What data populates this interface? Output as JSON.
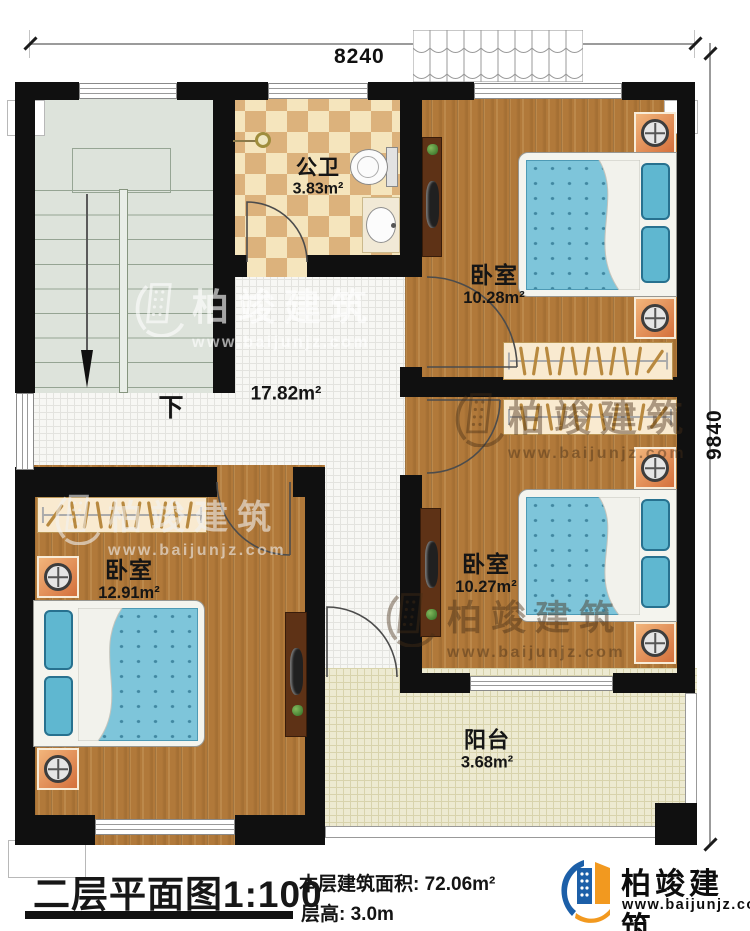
{
  "dimensions": {
    "width_mm": "8240",
    "height_mm": "9840"
  },
  "rooms": {
    "bathroom": {
      "name": "公卫",
      "area": "3.83m²"
    },
    "bedroom_tr": {
      "name": "卧室",
      "area": "10.28m²"
    },
    "bedroom_mr": {
      "name": "卧室",
      "area": "10.27m²"
    },
    "bedroom_bl": {
      "name": "卧室",
      "area": "12.91m²"
    },
    "hallway": {
      "area": "17.82m²"
    },
    "balcony": {
      "name": "阳台",
      "area": "3.68m²"
    },
    "stairs": {
      "direction": "下"
    }
  },
  "title_block": {
    "plan_title": "二层平面图",
    "scale": "1:100",
    "floor_area_label": "本层建筑面积:",
    "floor_area_value": "72.06m²",
    "floor_height_label": "层高:",
    "floor_height_value": "3.0m"
  },
  "brand": {
    "name": "柏竣建筑",
    "website": "www.baijunjz.com"
  },
  "watermark": {
    "text": "柏竣建筑",
    "website": "www.baijunjz.com"
  },
  "colors": {
    "wall": "#101010",
    "wood_floor": "#b1793a",
    "bed": "#7ec5da",
    "stair_floor": "#dde3db",
    "bath_tile_light": "#f5e5bd",
    "bath_tile_dark": "#dcb27c",
    "balcony_tile": "#edead1",
    "hall_tile": "#f7f7f4",
    "nightstand": "#e8975c",
    "brand_blue": "#1c5fa8",
    "brand_orange": "#f2991f"
  }
}
